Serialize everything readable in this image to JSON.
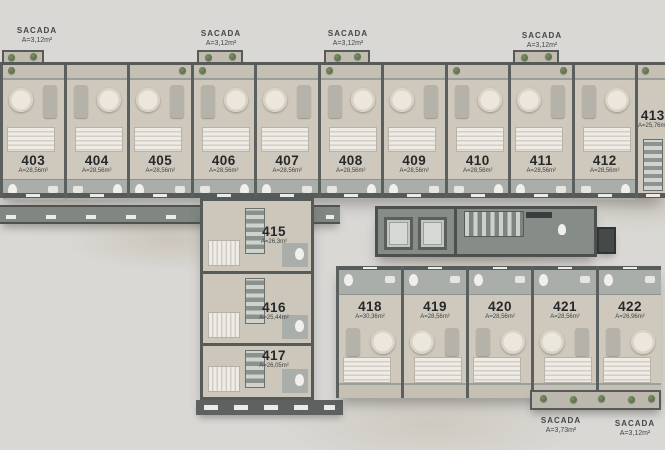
{
  "palette": {
    "background": "#d9d8d5",
    "unit_floor": "#cfc9bd",
    "wall": "#565b59",
    "core_floor": "#868d88",
    "bathroom_tile": "#a9aeab",
    "number_text": "#26292b",
    "sacada_text": "#42474a",
    "plant_green": "#5d7150"
  },
  "sacadas_top": [
    {
      "title": "SACADA",
      "area": "A=3,12m²"
    },
    {
      "title": "SACADA",
      "area": "A=3,12m²"
    },
    {
      "title": "SACADA",
      "area": "A=3,12m²"
    },
    {
      "title": "SACADA",
      "area": "A=3,12m²"
    }
  ],
  "units_top": [
    {
      "number": "403",
      "area": "A=28,56m²"
    },
    {
      "number": "404",
      "area": "A=28,56m²"
    },
    {
      "number": "405",
      "area": "A=28,56m²"
    },
    {
      "number": "406",
      "area": "A=28,56m²"
    },
    {
      "number": "407",
      "area": "A=28,56m²"
    },
    {
      "number": "408",
      "area": "A=28,56m²"
    },
    {
      "number": "409",
      "area": "A=28,56m²"
    },
    {
      "number": "410",
      "area": "A=28,56m²"
    },
    {
      "number": "411",
      "area": "A=28,56m²"
    },
    {
      "number": "412",
      "area": "A=28,56m²"
    },
    {
      "number": "413",
      "area": "A=25,76m²"
    }
  ],
  "units_wing": [
    {
      "number": "415",
      "area": "A=26,3m²"
    },
    {
      "number": "416",
      "area": "A=25,44m²"
    },
    {
      "number": "417",
      "area": "A=26,05m²"
    }
  ],
  "units_bottom": [
    {
      "number": "418",
      "area": "A=30,36m²"
    },
    {
      "number": "419",
      "area": "A=28,56m²"
    },
    {
      "number": "420",
      "area": "A=28,56m²"
    },
    {
      "number": "421",
      "area": "A=28,56m²"
    },
    {
      "number": "422",
      "area": "A=26,96m²"
    }
  ],
  "sacadas_bottom": [
    {
      "title": "SACADA",
      "area": "A=3,73m²"
    },
    {
      "title": "SACADA",
      "area": "A=3,12m²"
    }
  ]
}
